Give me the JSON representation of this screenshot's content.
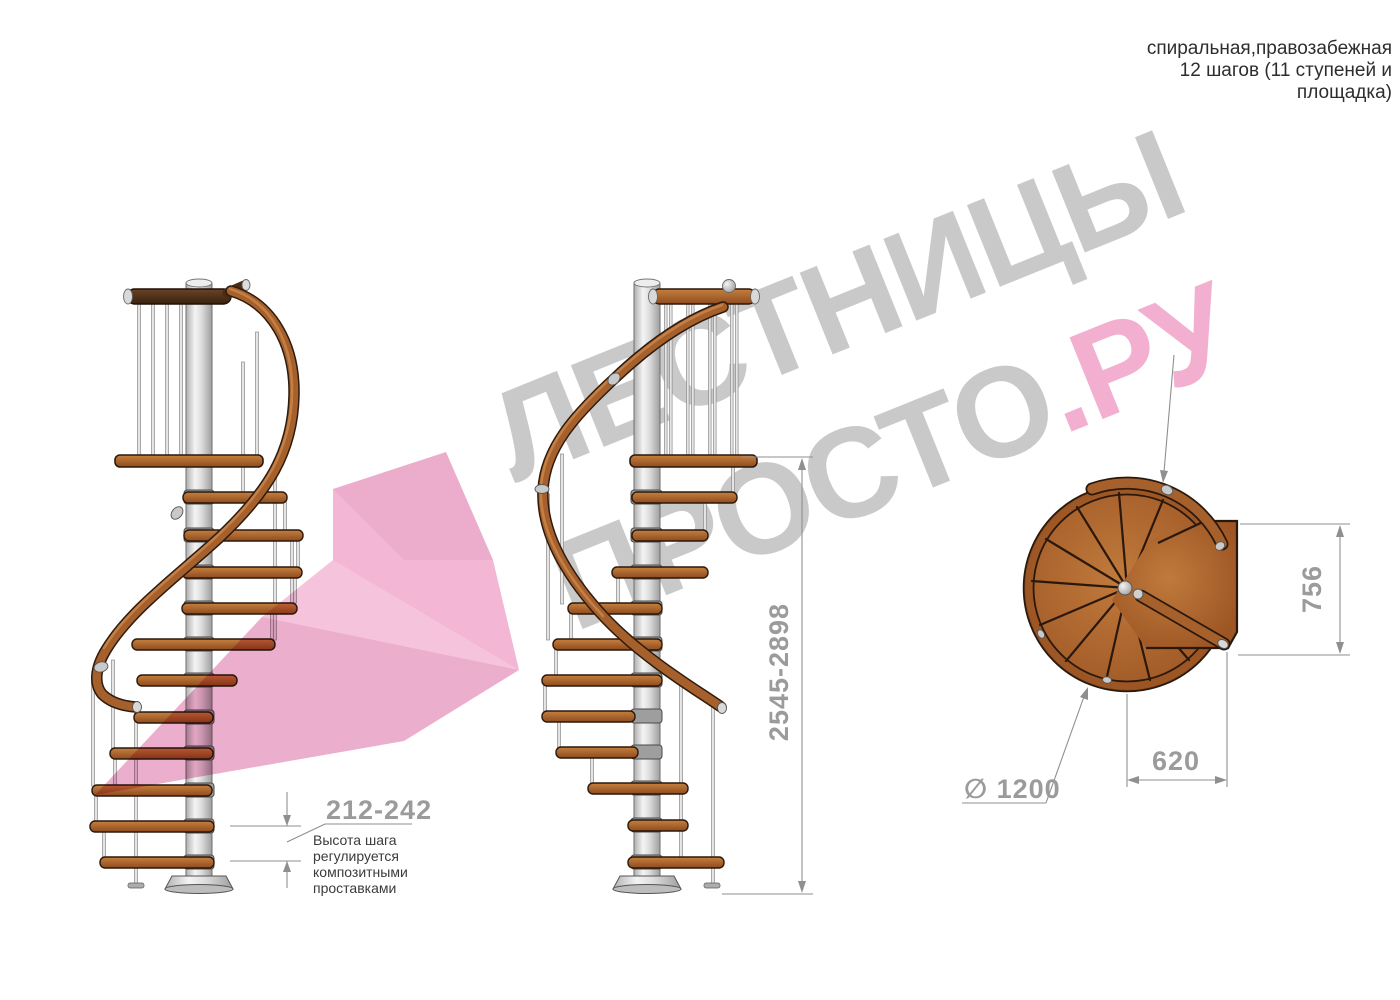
{
  "header": {
    "line1": "спиральная,правозабежная",
    "line2": "12 шагов (11 ступеней и",
    "line3": "площадка)"
  },
  "watermark": {
    "line1": "ЛЕСТНИЦЫ",
    "line2_main": "ПРОСТО",
    "line2_accent": ".РУ",
    "gray_color": "#c9c9c9",
    "pink_color": "#f2afd0"
  },
  "dimensions": {
    "step_height": {
      "value": "212-242",
      "note_line1": "Высота шага",
      "note_line2": "регулируется",
      "note_line3": "композитными",
      "note_line4": "проставками"
    },
    "total_height": {
      "value": "2545-2898"
    },
    "plan_depth": {
      "value": "756"
    },
    "plan_width": {
      "value": "620"
    },
    "diameter": {
      "value": "∅ 1200"
    }
  },
  "colors": {
    "wood": "#a5602c",
    "dark_wood": "#4a2c16",
    "metal": "#d9d9d9",
    "dimension_text": "#9b9b9b",
    "note_text": "#3b3b3b",
    "watermark_gray": "#c9c9c9",
    "watermark_pink": "#f2afd0",
    "arrow_pink": "#f2a9ce"
  }
}
